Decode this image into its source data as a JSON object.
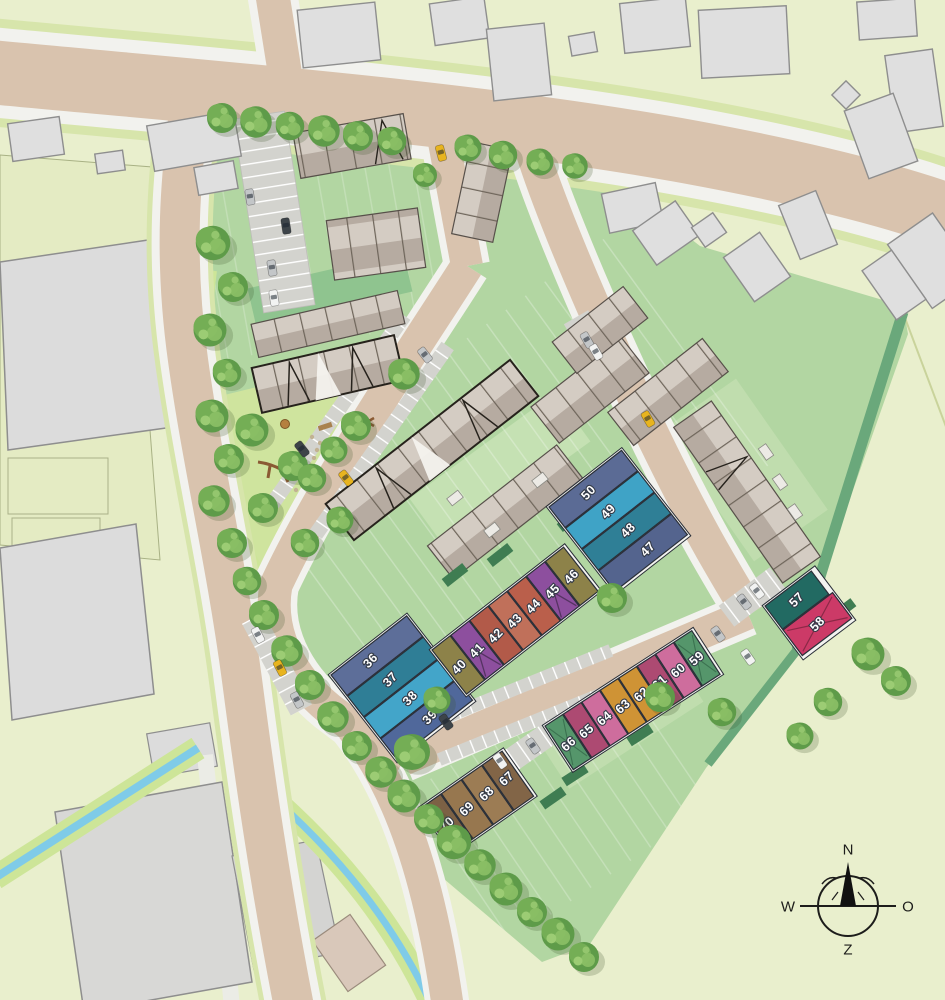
{
  "map_title": "residential development site plan",
  "compass": {
    "n": "N",
    "w": "W",
    "o": "O",
    "z": "Z"
  },
  "plots": {
    "g36": {
      "cells": [
        {
          "n": "36",
          "c": "#5d6e99"
        },
        {
          "n": "37",
          "c": "#2f7e96"
        },
        {
          "n": "38",
          "c": "#43a5c9"
        },
        {
          "n": "39",
          "c": "#50689b"
        }
      ]
    },
    "g47": {
      "cells": [
        {
          "n": "50",
          "c": "#5b6b95"
        },
        {
          "n": "49",
          "c": "#3fa3c6"
        },
        {
          "n": "48",
          "c": "#2f7f96"
        },
        {
          "n": "47",
          "c": "#54648e"
        }
      ]
    },
    "g40": {
      "cells": [
        {
          "n": "40",
          "c": "#8d8249"
        },
        {
          "n": "41",
          "c": "#8d4f9e"
        },
        {
          "n": "42",
          "c": "#b25a49"
        },
        {
          "n": "43",
          "c": "#c0705a"
        },
        {
          "n": "44",
          "c": "#ba5f4b"
        },
        {
          "n": "45",
          "c": "#8d4f9e"
        },
        {
          "n": "46",
          "c": "#8d8249"
        }
      ]
    },
    "g57": {
      "cells": [
        {
          "n": "57",
          "c": "#226a62"
        },
        {
          "n": "58",
          "c": "#cc3a67"
        }
      ]
    },
    "g59": {
      "cells": [
        {
          "n": "66",
          "c": "#55966b"
        },
        {
          "n": "65",
          "c": "#ad4a72"
        },
        {
          "n": "64",
          "c": "#ce6d9d"
        },
        {
          "n": "63",
          "c": "#cf9335"
        },
        {
          "n": "62",
          "c": "#cf9335"
        },
        {
          "n": "61",
          "c": "#ad4a72"
        },
        {
          "n": "60",
          "c": "#ce6d9d"
        },
        {
          "n": "59",
          "c": "#55966b"
        }
      ]
    },
    "g67": {
      "cells": [
        {
          "n": "70",
          "c": "#7c6145"
        },
        {
          "n": "69",
          "c": "#97774f"
        },
        {
          "n": "68",
          "c": "#9c7c54"
        },
        {
          "n": "67",
          "c": "#826547"
        }
      ]
    }
  },
  "palette": {
    "grass_light": "#e9efcd",
    "grass_dev": "#b2d6a2",
    "road": "#d9c3ae",
    "sidewalk": "#f2f2ee",
    "water": "#7fcbe8",
    "hedge": "#6aa87b",
    "building": "#dfdfdf",
    "roof_light": "#d4ccc3",
    "roof_dark": "#b6aba1",
    "car_yellow": "#e8b41f"
  }
}
